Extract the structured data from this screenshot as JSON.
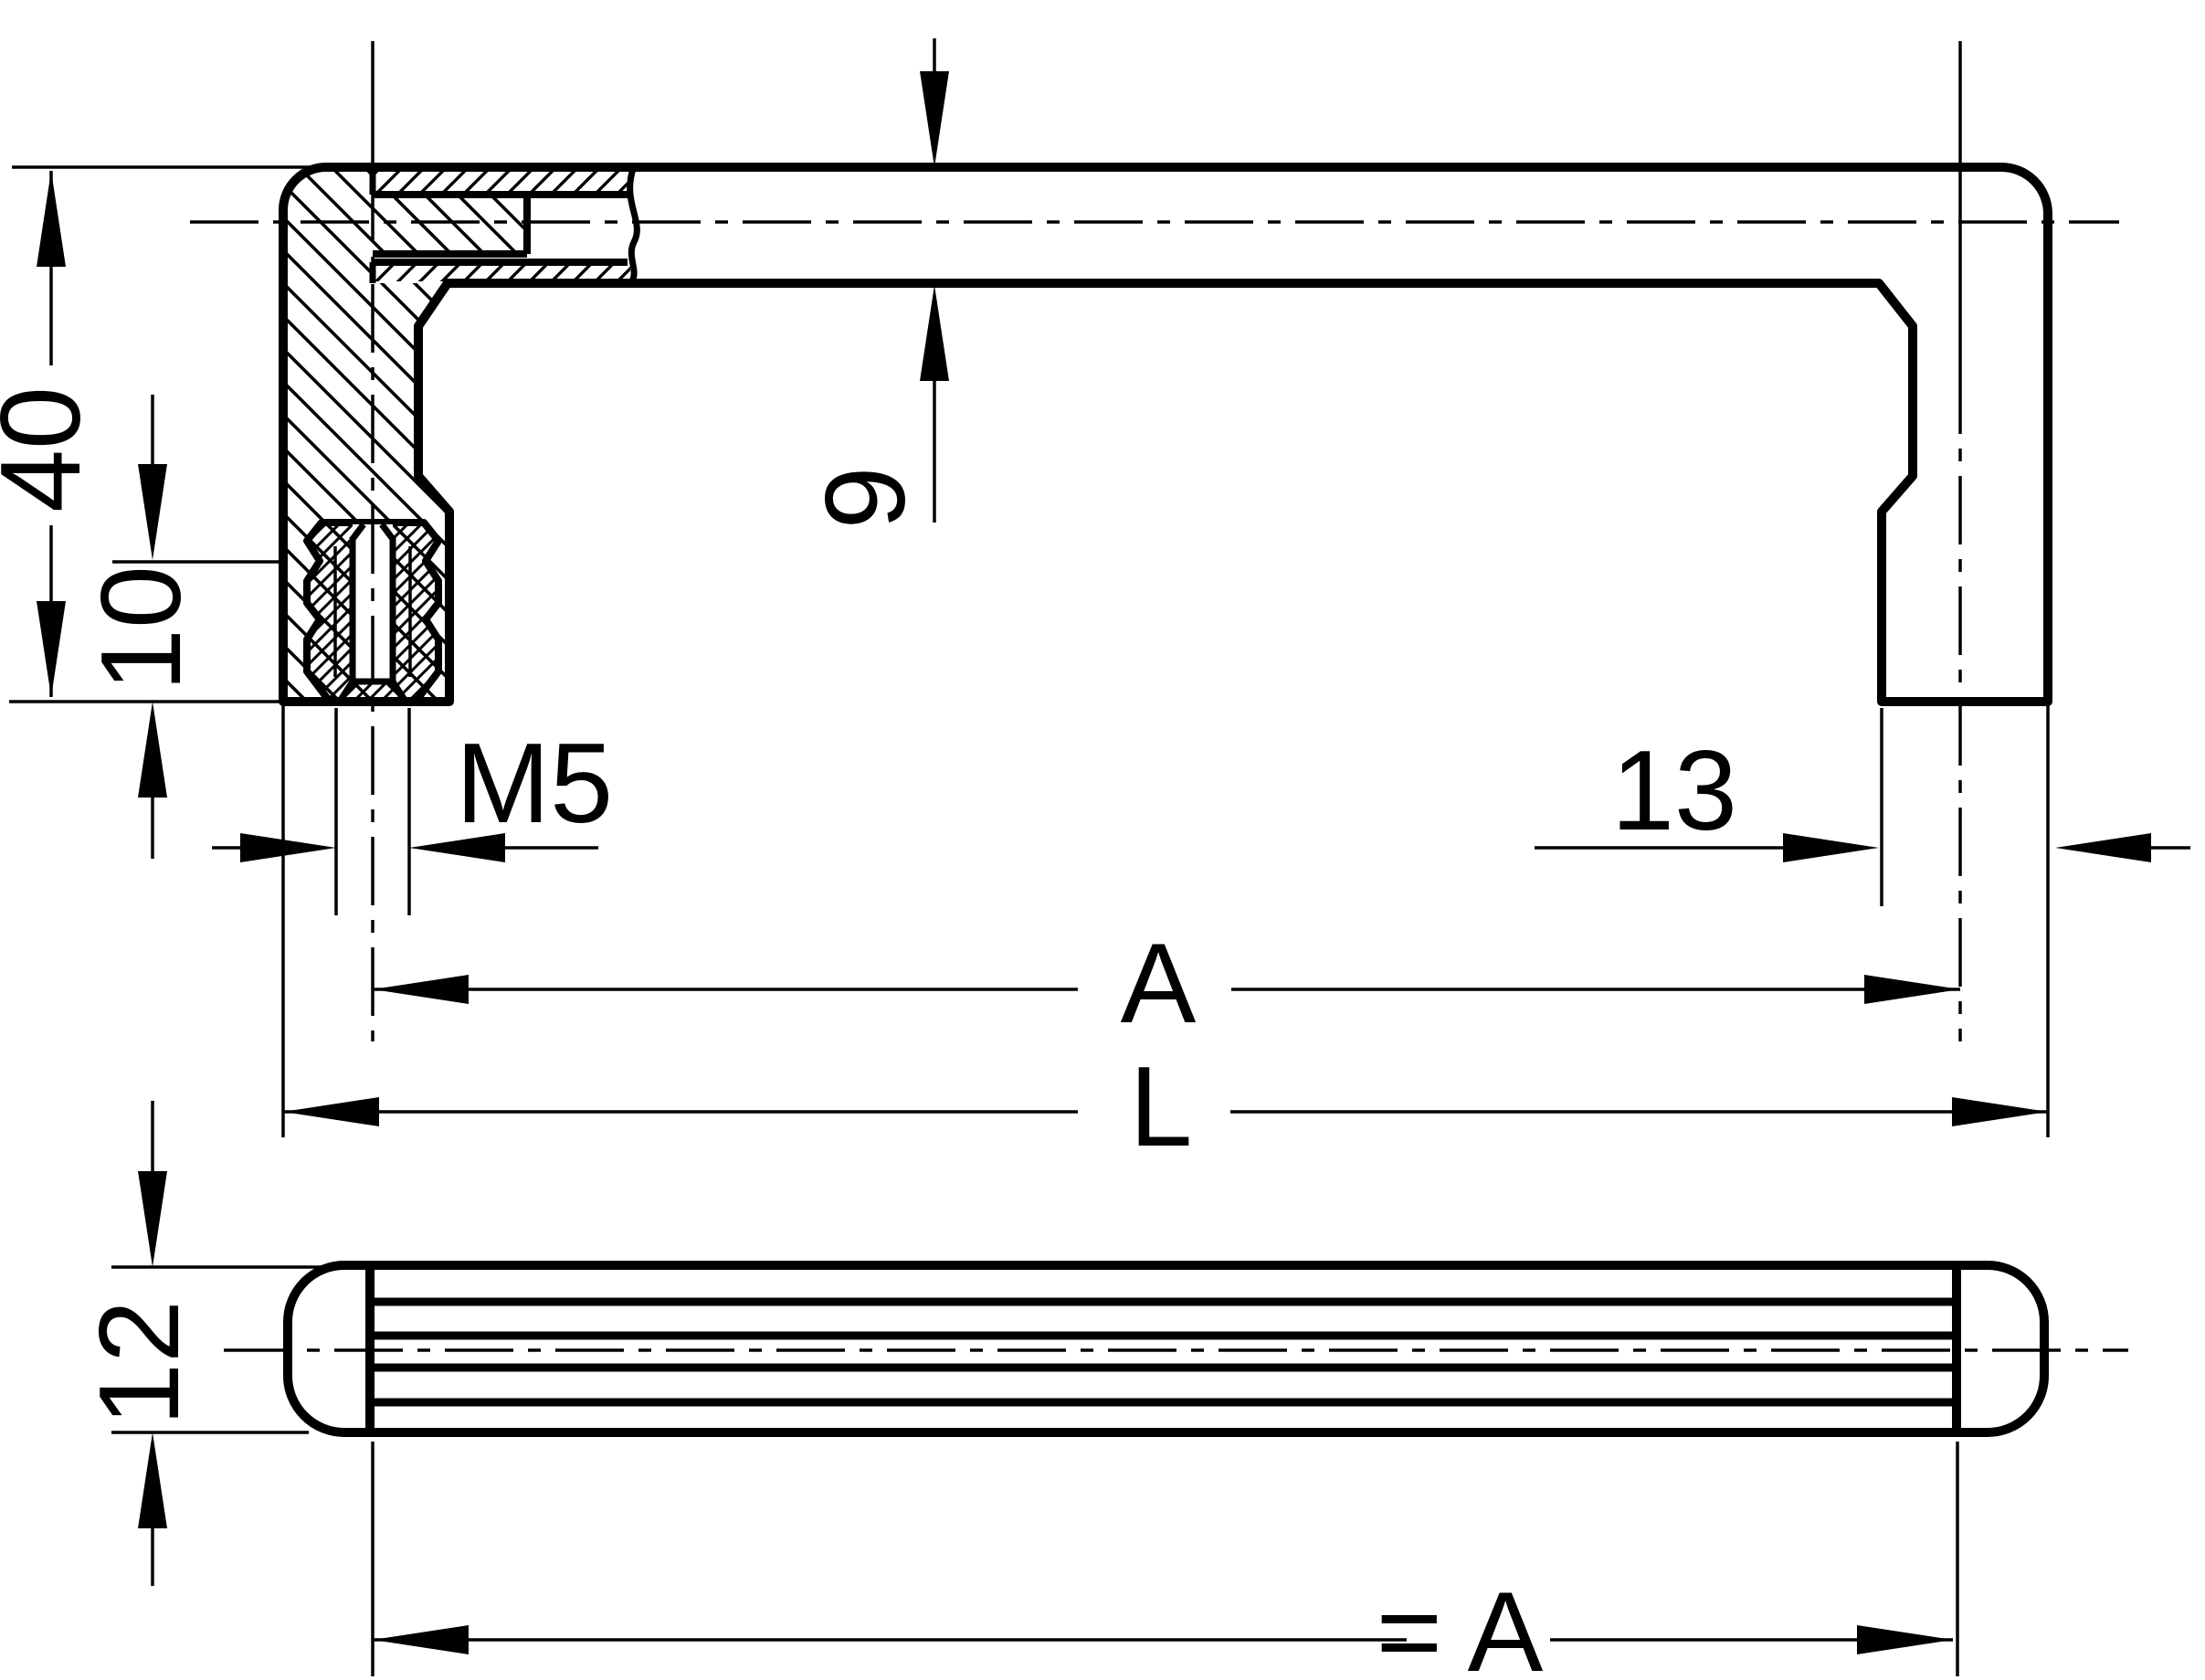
{
  "drawing": {
    "type": "technical-drawing",
    "subject": "cabinet pull handle, sectioned front view and bottom view",
    "colors": {
      "ink": "#000000",
      "background": "#ffffff"
    },
    "labels": {
      "height_overall": "40",
      "insert_depth": "10",
      "bar_thickness": "9",
      "thread": "M5",
      "foot_width": "13",
      "hole_spacing": "A",
      "overall_length": "L",
      "profile_height": "12",
      "equals_hole_spacing": "= A"
    }
  }
}
